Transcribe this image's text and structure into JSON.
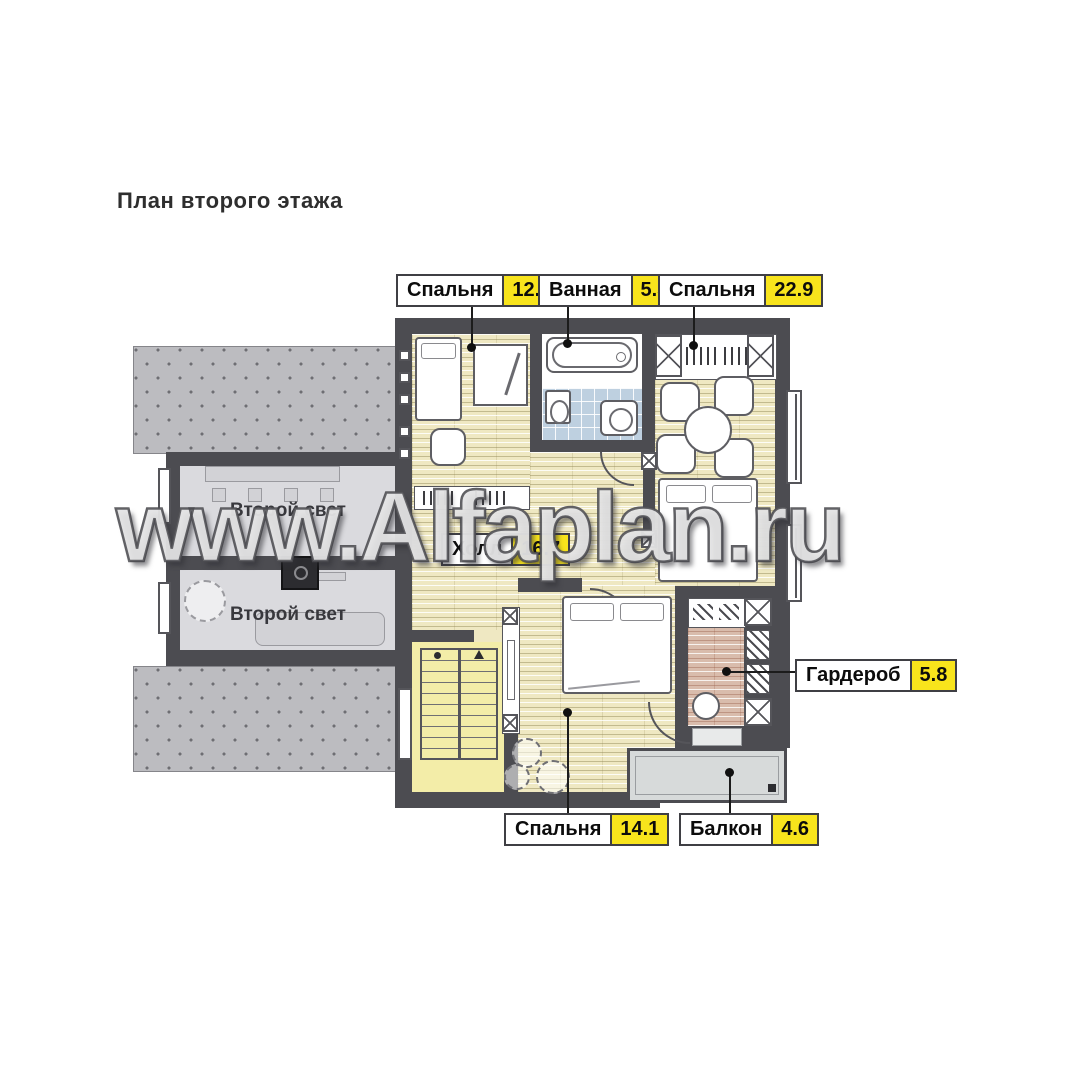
{
  "title": "План второго этажа",
  "watermark": "www.Alfaplan.ru",
  "callouts": {
    "bedroom_top_left": {
      "label": "Спальня",
      "area": "12.3"
    },
    "bathroom": {
      "label": "Ванная",
      "area": "5.3"
    },
    "bedroom_top_right": {
      "label": "Спальня",
      "area": "22.9"
    },
    "hall": {
      "label": "Холл",
      "area": "16.7"
    },
    "wardrobe": {
      "label": "Гардероб",
      "area": "5.8"
    },
    "bedroom_bottom": {
      "label": "Спальня",
      "area": "14.1"
    },
    "balcony": {
      "label": "Балкон",
      "area": "4.6"
    }
  },
  "second_light": {
    "upper": "Второй свет",
    "lower": "Второй свет"
  },
  "colors": {
    "wall": "#4c4c51",
    "plank_floor": "#efe8c2",
    "stair_floor": "#f3eda8",
    "tile_floor": "#bed0e0",
    "wardrobe_floor": "#d9bcac",
    "roof_gray": "#bcbcc0",
    "second_light_floor": "#dadade",
    "balcony_floor": "#d7dada",
    "area_highlight": "#f8e41c",
    "label_text": "#0c0c0c"
  }
}
